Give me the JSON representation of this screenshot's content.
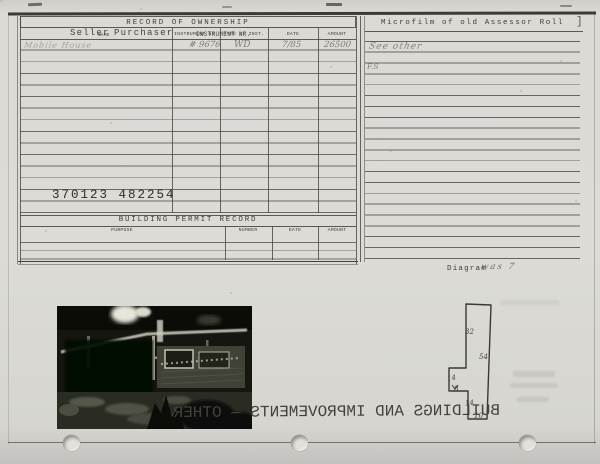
{
  "ownership": {
    "title": "RECORD OF OWNERSHIP",
    "col_seller": "Seller",
    "col_name": "NAME",
    "col_purchaser": "Purchaser",
    "col_instrument": "INSTRUMENT NR.",
    "col_type": "TYPE of INST.",
    "col_date": "DATE",
    "col_amount": "AMOUNT",
    "entry": {
      "seller": "Mobile House",
      "instrument_nr": "# 9676",
      "type_of_inst": "WD",
      "date": "7/85",
      "amount": "26500"
    },
    "reference_numbers": "370123    482254"
  },
  "building_permit": {
    "title": "BUILDING PERMIT RECORD",
    "col_purpose": "PURPOSE",
    "col_number": "NUMBER",
    "col_date": "DATE",
    "col_amount": "AMOUNT"
  },
  "microfilm": {
    "title": "Microfilm of old Assessor Roll",
    "bracket": "]",
    "note1": "See other",
    "note2": "F.S"
  },
  "diagram": {
    "label": "Diagram",
    "annotation": "was 7",
    "dims": {
      "d32": "32",
      "d54": "54",
      "d14a": "14",
      "d8": "8",
      "d14b": "14",
      "d10": "10"
    }
  },
  "bleed": {
    "line1": "BUILDINGS AND IMPROVEMENTS — OTHER"
  }
}
